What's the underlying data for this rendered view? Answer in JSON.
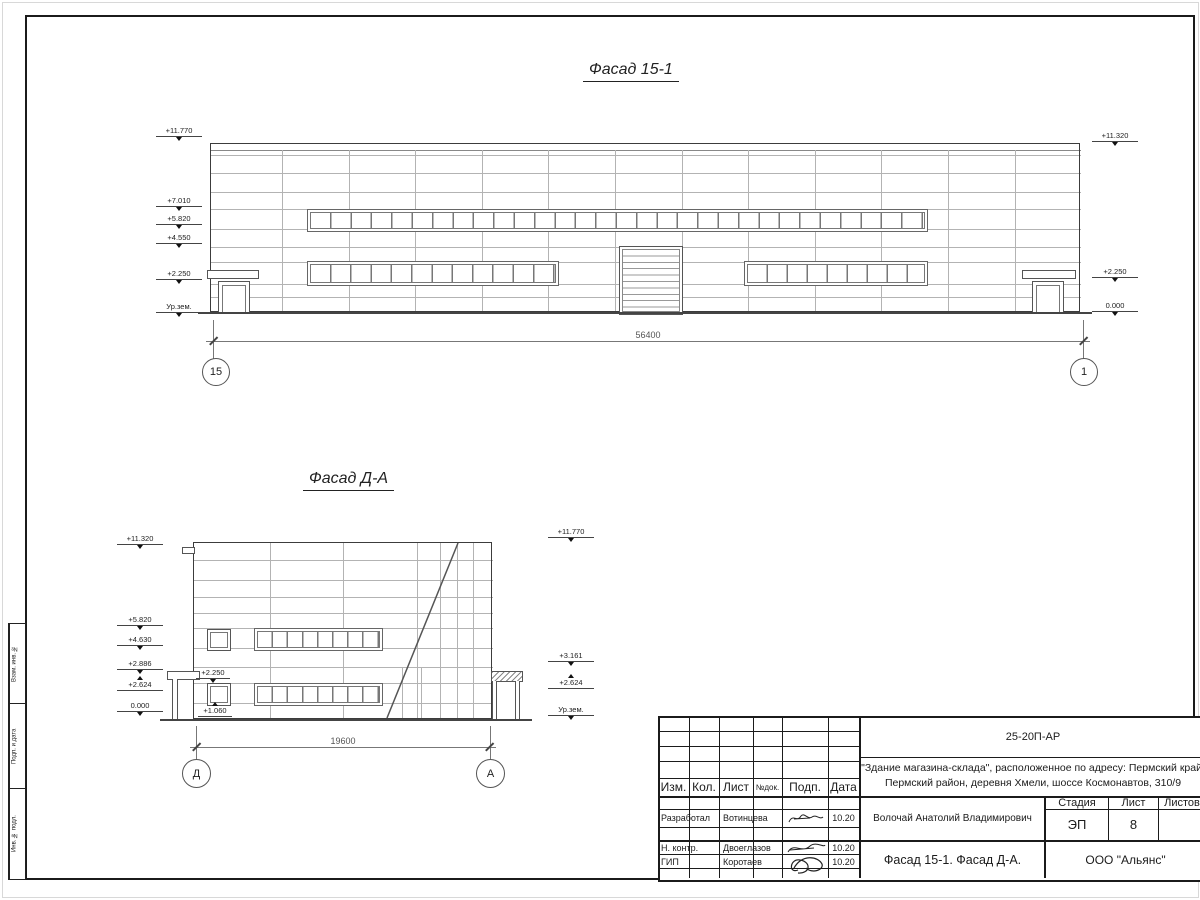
{
  "facade1": {
    "title": "Фасад 15-1",
    "dim": "56400",
    "axis_left": "15",
    "axis_right": "1",
    "marks_left": [
      "+11.770",
      "+7.010",
      "+5.820",
      "+4.550",
      "+2.250",
      "Ур.зем."
    ],
    "marks_right": [
      "+11.320",
      "+2.250",
      "0.000"
    ]
  },
  "facade2": {
    "title": "Фасад Д-А",
    "dim": "19600",
    "axis_left": "Д",
    "axis_right": "А",
    "marks_left": [
      "+11.320",
      "+5.820",
      "+4.630",
      "+2.886",
      "+2.624",
      "0.000"
    ],
    "marks_right": [
      "+11.770",
      "+3.161",
      "+2.624",
      "Ур.зем."
    ],
    "inner_marks": [
      "+2.250",
      "+1.060"
    ]
  },
  "frame": {
    "stamps": [
      "Взам. инв. №",
      "Подп. и дата",
      "Инв. № подл."
    ]
  },
  "titleblock": {
    "doc_number": "25-20П-АР",
    "project_line1": "\"Здание магазина-склада\", расположенное по адресу: Пермский край,",
    "project_line2": "Пермский район, деревня Хмели, шоссе Космонавтов, 310/9",
    "header_cols": [
      "Изм.",
      "Кол.",
      "Лист",
      "№док.",
      "Подп.",
      "Дата"
    ],
    "rows": [
      {
        "role": "Разработал",
        "name": "Вотинцева",
        "date": "10.20"
      },
      {
        "role": "Н. контр.",
        "name": "Двоеглазов",
        "date": "10.20"
      },
      {
        "role": "ГИП",
        "name": "Коротаев",
        "date": "10.20"
      }
    ],
    "chief": "Волочай Анатолий Владимирович",
    "stage_label": "Стадия",
    "sheet_label": "Лист",
    "sheets_label": "Листов",
    "stage_value": "ЭП",
    "sheet_value": "8",
    "sheet_title": "Фасад 15-1. Фасад Д-А.",
    "company": "ООО \"Альянс\""
  }
}
